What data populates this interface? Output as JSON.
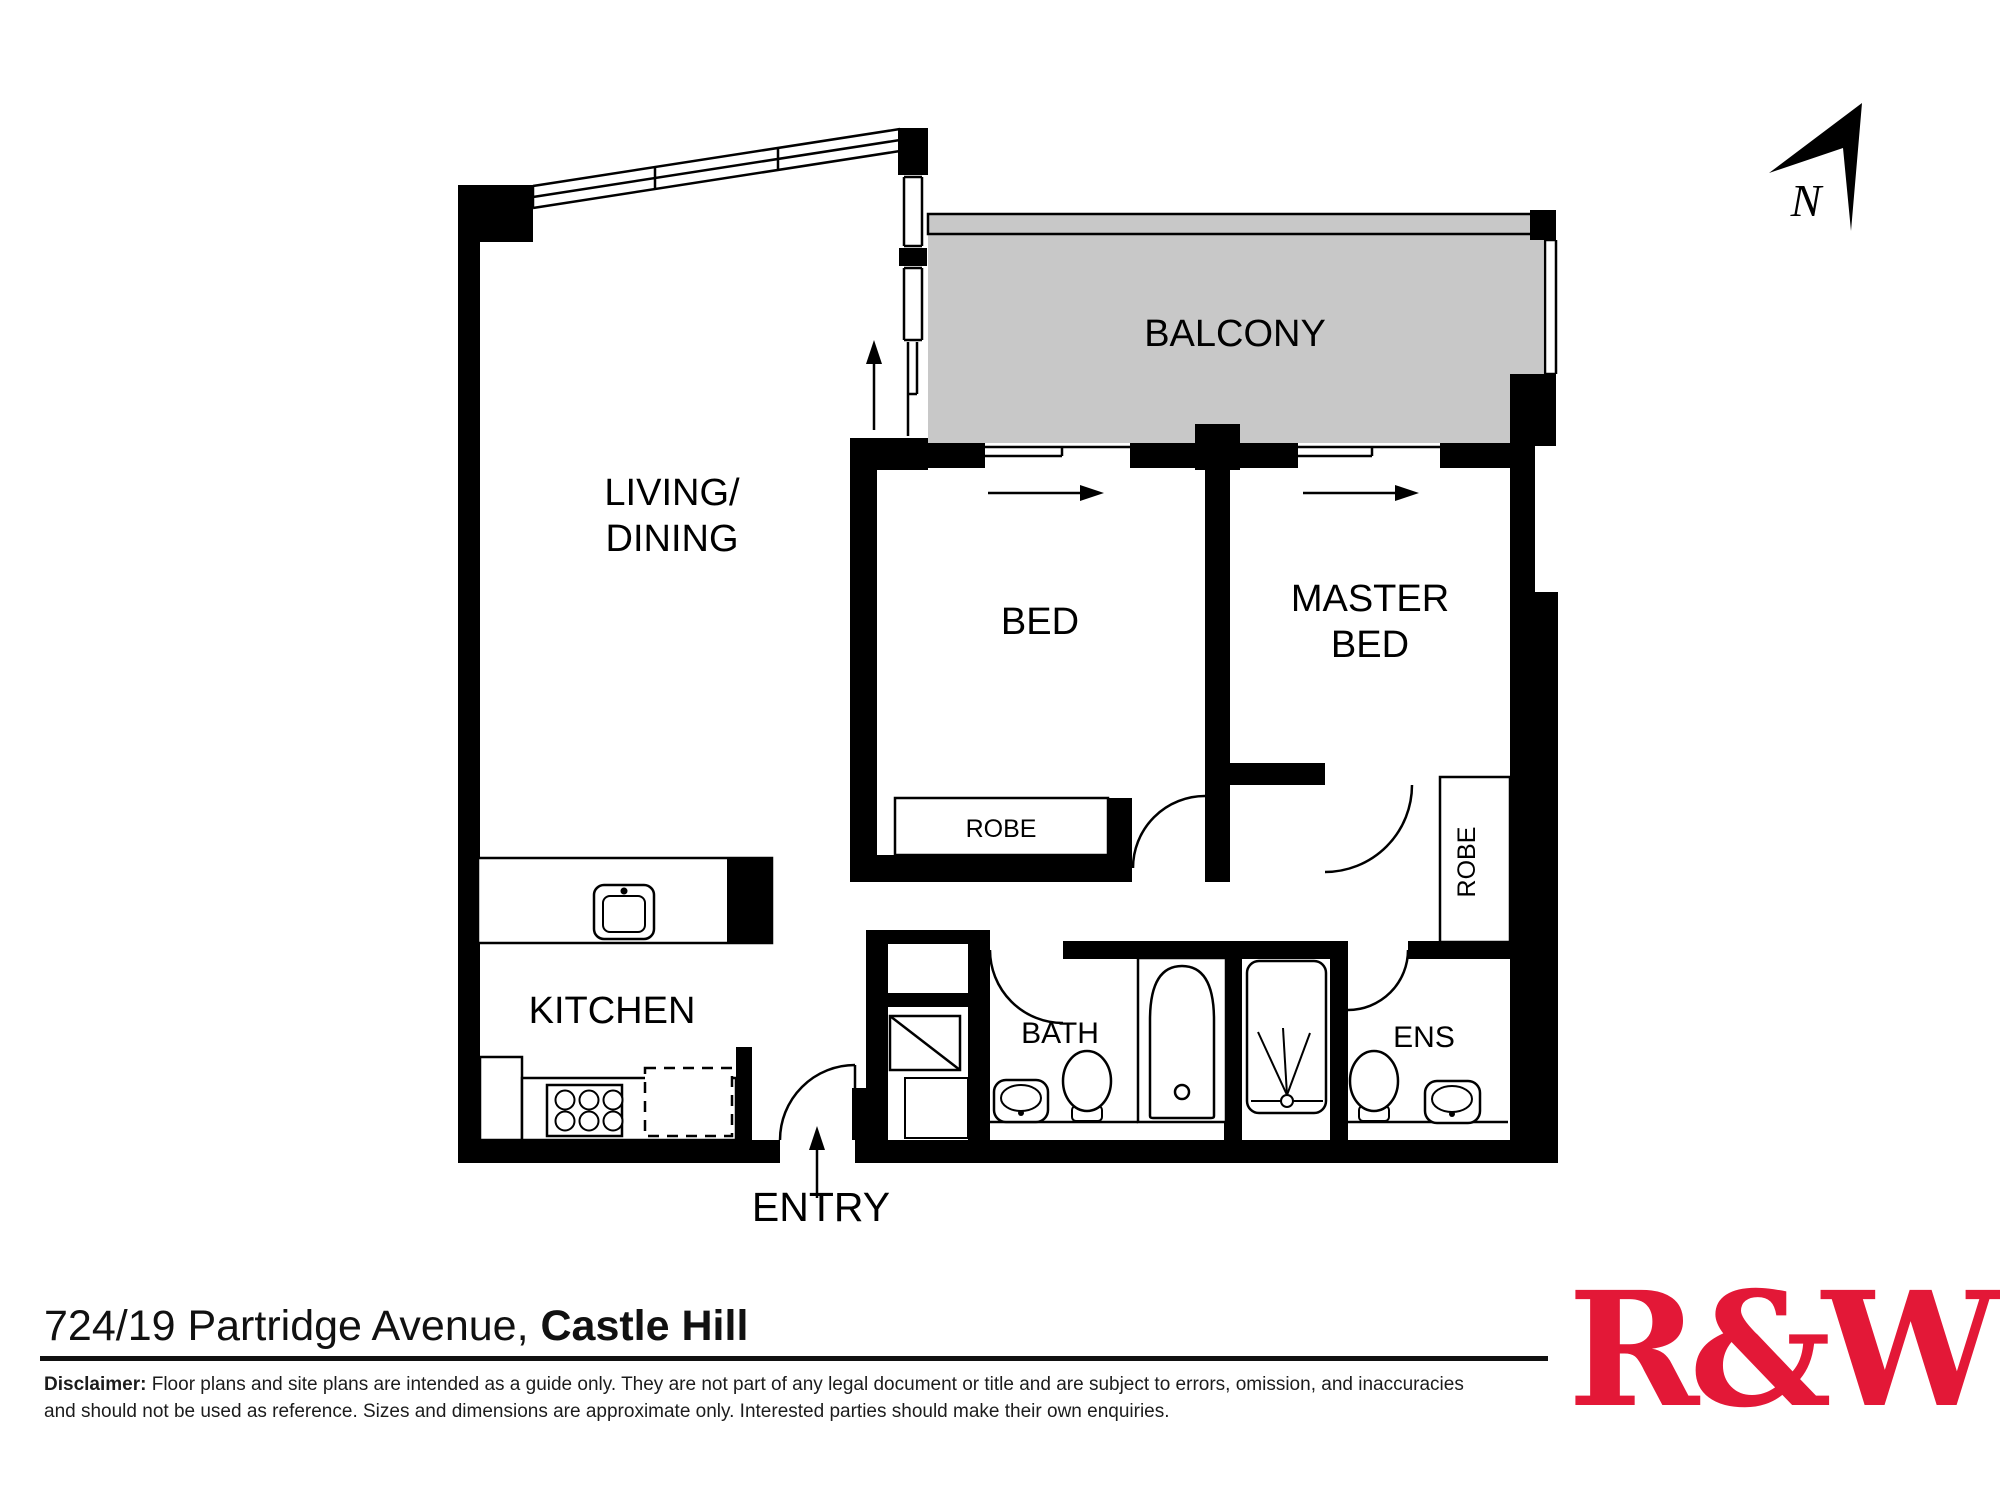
{
  "floor_plan": {
    "north_indicator": "N",
    "rooms": {
      "balcony": "BALCONY",
      "living_line1": "LIVING/",
      "living_line2": "DINING",
      "bed": "BED",
      "master_line1": "MASTER",
      "master_line2": "BED",
      "kitchen": "KITCHEN",
      "bath": "BATH",
      "ens": "ENS",
      "entry": "ENTRY",
      "robe_bed": "ROBE",
      "robe_master": "ROBE"
    }
  },
  "footer": {
    "address_regular": "724/19 Partridge Avenue, ",
    "address_bold": "Castle Hill",
    "disclaimer_label": "Disclaimer:",
    "disclaimer_line1": " Floor plans and site plans are intended as a guide only. They are not part of any legal document or title and are subject to errors, omission, and inaccuracies",
    "disclaimer_line2": "and should not be used as reference. Sizes and dimensions are approximate only. Interested parties should make their own enquiries.",
    "logo_text": "R&W"
  },
  "colors": {
    "balcony_gray": "#C8C8C8",
    "wall_black": "#000000",
    "logo_red": "#E31837"
  }
}
